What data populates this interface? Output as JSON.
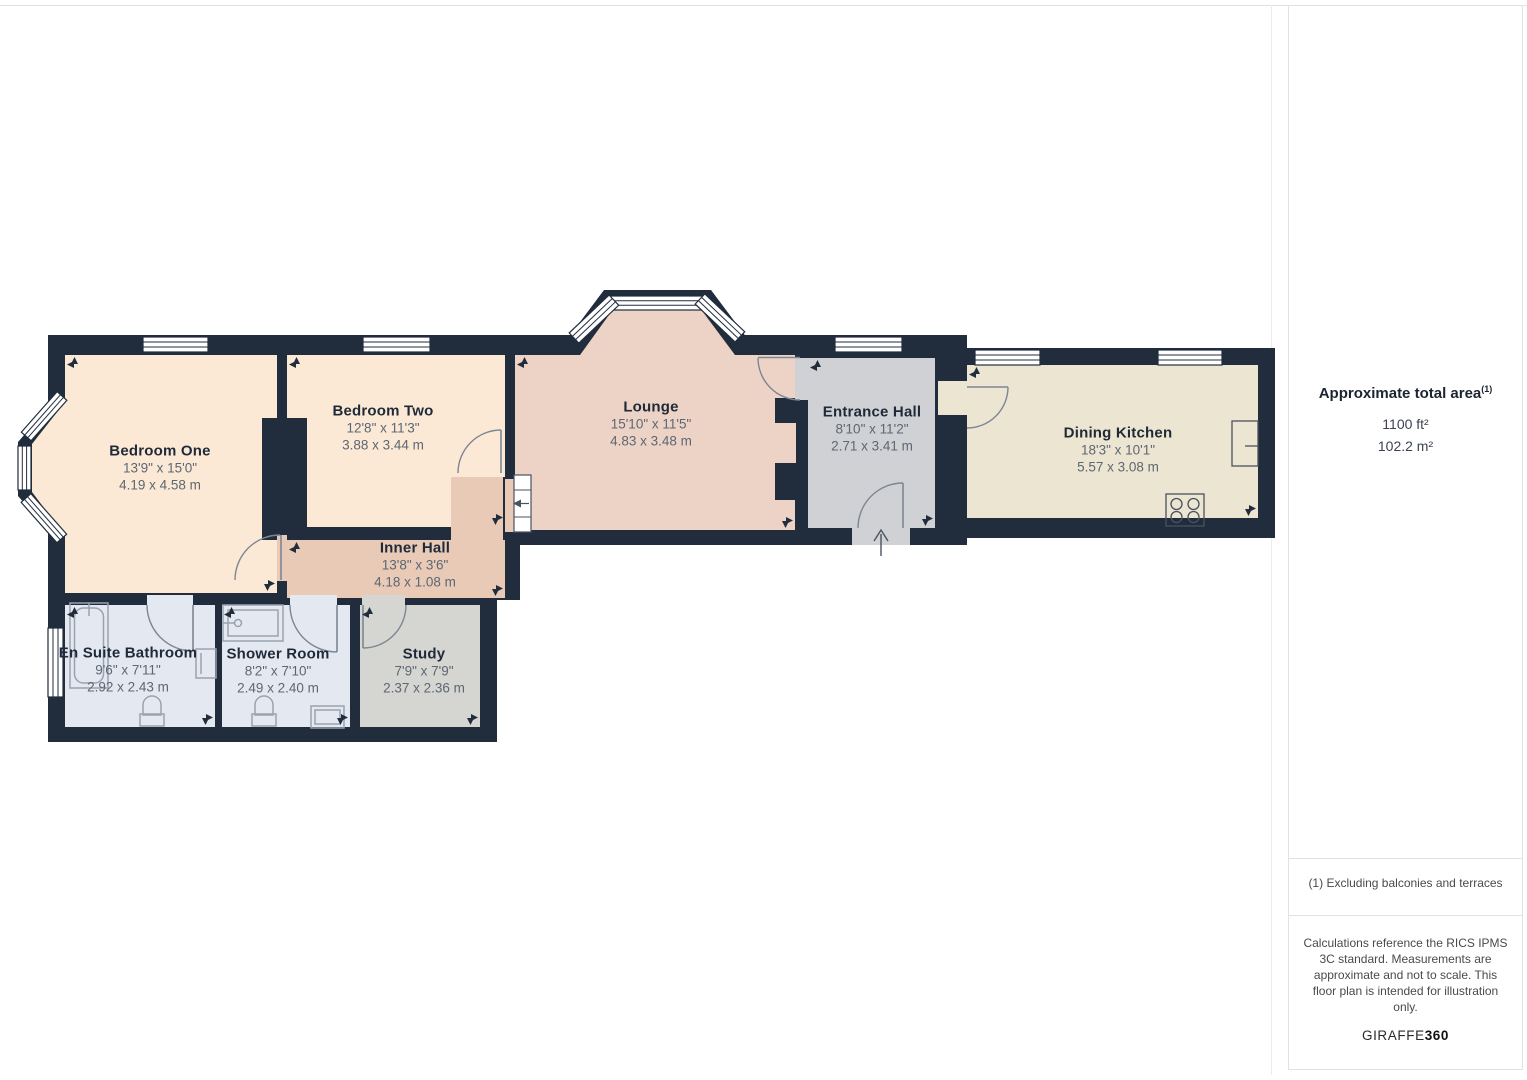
{
  "colors": {
    "wall": "#212d3d",
    "bedroom": "#fbe9d6",
    "lounge": "#edd3c6",
    "inner_hall": "#e9cab6",
    "entrance": "#d0d1d4",
    "kitchen": "#ece5d1",
    "bathroom": "#e4e8f1",
    "study": "#d5d5d1",
    "door_stroke": "#7d8694",
    "fixture": "#9aa2af",
    "label": "#1f2a38",
    "dims": "#5d6773"
  },
  "rooms": [
    {
      "id": "bedroom-one",
      "name": "Bedroom One",
      "imperial": "13'9\" x 15'0\"",
      "metric": "4.19 x 4.58 m"
    },
    {
      "id": "bedroom-two",
      "name": "Bedroom Two",
      "imperial": "12'8\" x 11'3\"",
      "metric": "3.88 x 3.44 m"
    },
    {
      "id": "lounge",
      "name": "Lounge",
      "imperial": "15'10\" x 11'5\"",
      "metric": "4.83 x 3.48 m"
    },
    {
      "id": "entrance-hall",
      "name": "Entrance Hall",
      "imperial": "8'10\" x 11'2\"",
      "metric": "2.71 x 3.41 m"
    },
    {
      "id": "dining-kitchen",
      "name": "Dining Kitchen",
      "imperial": "18'3\" x 10'1\"",
      "metric": "5.57 x 3.08 m"
    },
    {
      "id": "inner-hall",
      "name": "Inner Hall",
      "imperial": "13'8\" x 3'6\"",
      "metric": "4.18 x 1.08 m"
    },
    {
      "id": "en-suite-bathroom",
      "name": "En Suite Bathroom",
      "imperial": "9'6\" x 7'11\"",
      "metric": "2.92 x 2.43 m"
    },
    {
      "id": "shower-room",
      "name": "Shower Room",
      "imperial": "8'2\" x 7'10\"",
      "metric": "2.49 x 2.40 m"
    },
    {
      "id": "study",
      "name": "Study",
      "imperial": "7'9\" x 7'9\"",
      "metric": "2.37 x 2.36 m"
    }
  ],
  "sidebar": {
    "title": "Approximate total area",
    "title_superscript": "(1)",
    "area_imperial": "1100 ft²",
    "area_metric": "102.2 m²",
    "footnote": "(1) Excluding balconies and terraces",
    "disclaimer": "Calculations reference the RICS IPMS 3C standard. Measurements are approximate and not to scale. This floor plan is intended for illustration only.",
    "brand_name": "GIRAFFE",
    "brand_suffix": "360"
  }
}
